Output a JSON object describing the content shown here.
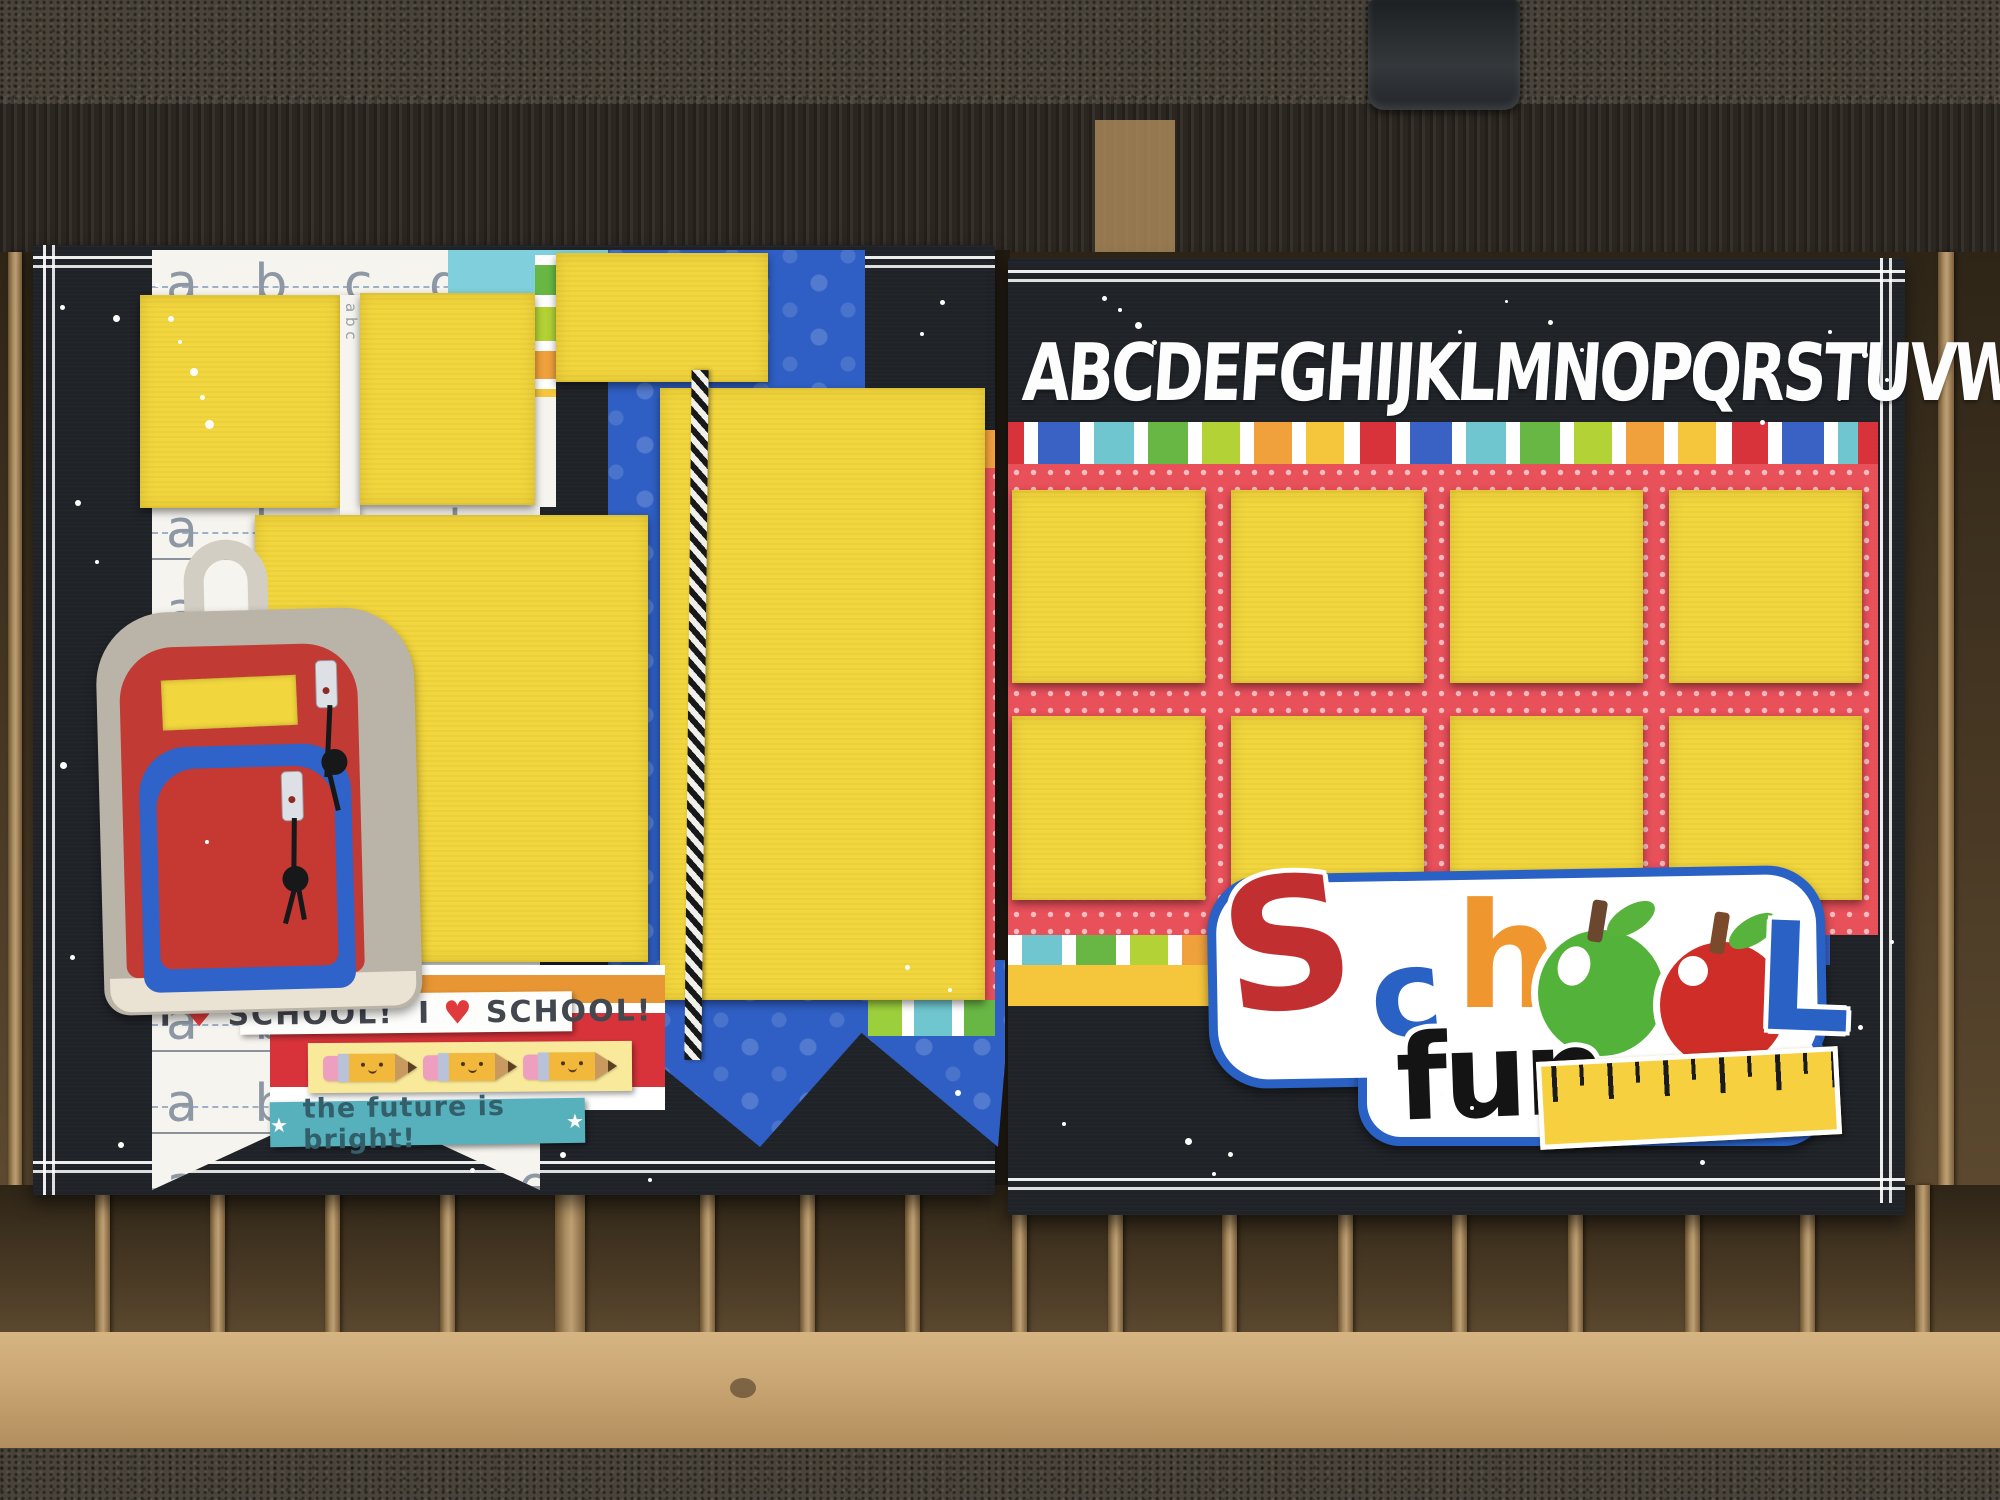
{
  "scene": {
    "colors": {
      "page_black": "#1f2227",
      "mat_yellow": "#f2d63e",
      "polka_red": "#e8505a",
      "star_blue": "#2f5fc4",
      "teal_strip": "#7fd0dc",
      "future_teal": "#57b1bd",
      "wood": "#8a6a45"
    }
  },
  "left_page": {
    "handwriting_row_text": "a b c d e f g",
    "vertical_letters": "a b c",
    "love_strip": {
      "i1": "I",
      "h1": "♥",
      "w1": "SCHOOL!",
      "i2": "I",
      "h2": "♥",
      "w2": "SCHOOL!"
    },
    "future_strip": {
      "star_left": "★",
      "text": "the future is bright!",
      "star_right": "★"
    }
  },
  "right_page": {
    "alphabet": "ABCDEFGHIJKLMNOPQRSTUVWXYZ",
    "title": {
      "letter_s": "S",
      "letter_c": "c",
      "letter_h": "h",
      "letter_l": "L",
      "word_fun": "fun"
    }
  }
}
